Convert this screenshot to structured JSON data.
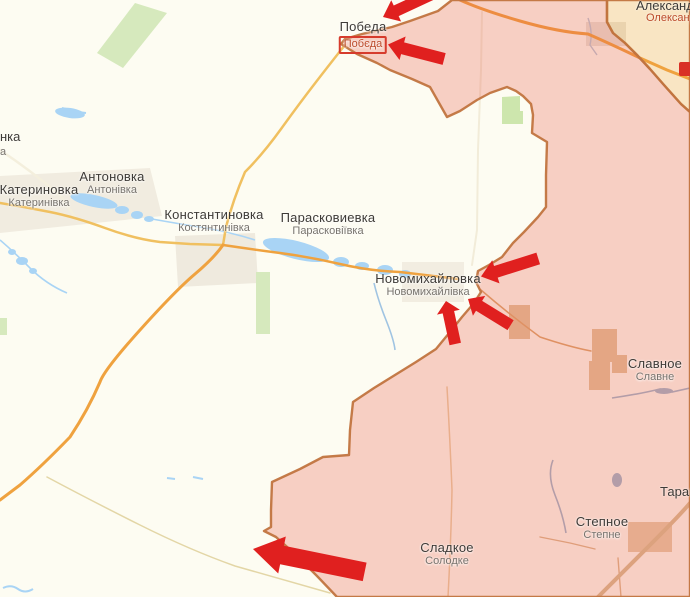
{
  "map": {
    "name": "frontline-map",
    "colors": {
      "occupied_fill": "#e85546",
      "occupied_border": "#c1743f",
      "liberated_fill": "#f0a33c",
      "arrow_red": "#e0201f",
      "water": "#a9d4f5",
      "road_main": "#efa23f",
      "forest": "#d6e9bd",
      "badge_red": "#d93025"
    },
    "settlements": [
      {
        "id": "pobeda",
        "ru": "Победа",
        "ua": "Побєда",
        "x": 363,
        "y": 19,
        "ua_red": true,
        "boxed": true
      },
      {
        "id": "katerynivka",
        "ru": "Катериновка",
        "ua": "Катеринівка",
        "x": 39,
        "y": 182,
        "ua_red": false,
        "boxed": false
      },
      {
        "id": "antonivka",
        "ru": "Антоновка",
        "ua": "Антонівка",
        "x": 112,
        "y": 169,
        "ua_red": false,
        "boxed": false
      },
      {
        "id": "kostiantynivka",
        "ru": "Константиновка",
        "ua": "Костянтинівка",
        "x": 214,
        "y": 207,
        "ua_red": false,
        "boxed": false
      },
      {
        "id": "paraskoviivka",
        "ru": "Парасковиевка",
        "ua": "Парасковіївка",
        "x": 328,
        "y": 210,
        "ua_red": false,
        "boxed": false
      },
      {
        "id": "novomykhailivka",
        "ru": "Новомихайловка",
        "ua": "Новомихайлівка",
        "x": 428,
        "y": 271,
        "ua_red": false,
        "boxed": false
      },
      {
        "id": "slavne",
        "ru": "Славное",
        "ua": "Славне",
        "x": 655,
        "y": 356,
        "ua_red": false,
        "boxed": false
      },
      {
        "id": "stepne",
        "ru": "Степное",
        "ua": "Степне",
        "x": 602,
        "y": 514,
        "ua_red": false,
        "boxed": false
      },
      {
        "id": "solodke",
        "ru": "Сладкое",
        "ua": "Солодке",
        "x": 447,
        "y": 540,
        "ua_red": false,
        "boxed": false
      }
    ],
    "label_fragments": [
      {
        "id": "frag-left-ru",
        "text": "нка",
        "x": 0,
        "y": 129,
        "style": "ru"
      },
      {
        "id": "frag-left-ua",
        "text": "а",
        "x": 0,
        "y": 146,
        "style": "ua"
      },
      {
        "id": "frag-oleksandr-ru",
        "text": "Александ",
        "x": 636,
        "y": -2,
        "style": "ru"
      },
      {
        "id": "frag-oleksandr-ua",
        "text": "Олександ",
        "x": 646,
        "y": 12,
        "style": "ua-red"
      },
      {
        "id": "frag-taram",
        "text": "Тарам",
        "x": 660,
        "y": 484,
        "style": "ru"
      }
    ],
    "attack_arrows": [
      {
        "id": "arrow-pobeda-north",
        "x": 383,
        "y": 17,
        "rot": -25,
        "len": 56,
        "h": 26
      },
      {
        "id": "arrow-pobeda-east",
        "x": 388,
        "y": 44,
        "rot": 14.5,
        "len": 58,
        "h": 27
      },
      {
        "id": "arrow-novomykhailivka-east",
        "x": 481,
        "y": 276,
        "rot": -17.5,
        "len": 60,
        "h": 27
      },
      {
        "id": "arrow-novomykhailivka-se",
        "x": 468,
        "y": 299,
        "rot": 31.6,
        "len": 50,
        "h": 26
      },
      {
        "id": "arrow-novomykhailivka-south",
        "x": 446,
        "y": 301,
        "rot": 77.9,
        "len": 44,
        "h": 26
      },
      {
        "id": "arrow-west-breakthrough",
        "x": 253,
        "y": 549,
        "rot": 11.6,
        "len": 114,
        "h": 42
      }
    ],
    "road_badge": {
      "x": 679,
      "y": 62,
      "w": 12,
      "h": 14
    }
  }
}
